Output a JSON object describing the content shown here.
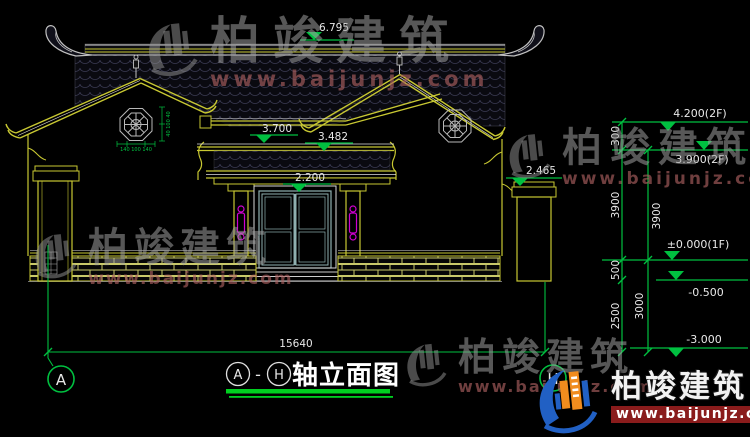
{
  "watermark": {
    "brand": "柏竣建筑",
    "url": "www.baijunjz.com"
  },
  "brand_logo": {
    "brand": "柏竣建筑",
    "url": "www.baijunjz.com"
  },
  "levels": {
    "ridge": "6.795",
    "main_eave": "3.700",
    "porch_eave": "3.482",
    "door_head": "2.200",
    "side_wall": "2.465",
    "parapet_2f": "4.200(2F)",
    "floor_2f": "3.900(2F)",
    "floor_1f": "±0.000(1F)",
    "grade": "-0.500",
    "footing": "-3.000"
  },
  "dims": {
    "total_width": "15640",
    "v300": "300",
    "v3900_outer": "3900",
    "v3900_inner": "3900",
    "v500": "500",
    "v2500": "2500",
    "v3000": "3000",
    "window_h": "140 100 140",
    "window_v": "40 100 40"
  },
  "axis": {
    "left": "A",
    "right": "H"
  },
  "title": {
    "axis_from": "A",
    "dash": "-",
    "axis_to": "H",
    "label": "轴立面图"
  },
  "colors": {
    "background": "#000000",
    "cad_green": "#00c040",
    "cad_yellow": "#c8c832",
    "cad_white": "#e0e0e0",
    "magenta": "#d000d0",
    "brand_orange": "#f08c1e",
    "brand_blue": "#2160c4",
    "logo_red": "#8a1c1c",
    "watermark_gray": "#9e9e9e"
  }
}
